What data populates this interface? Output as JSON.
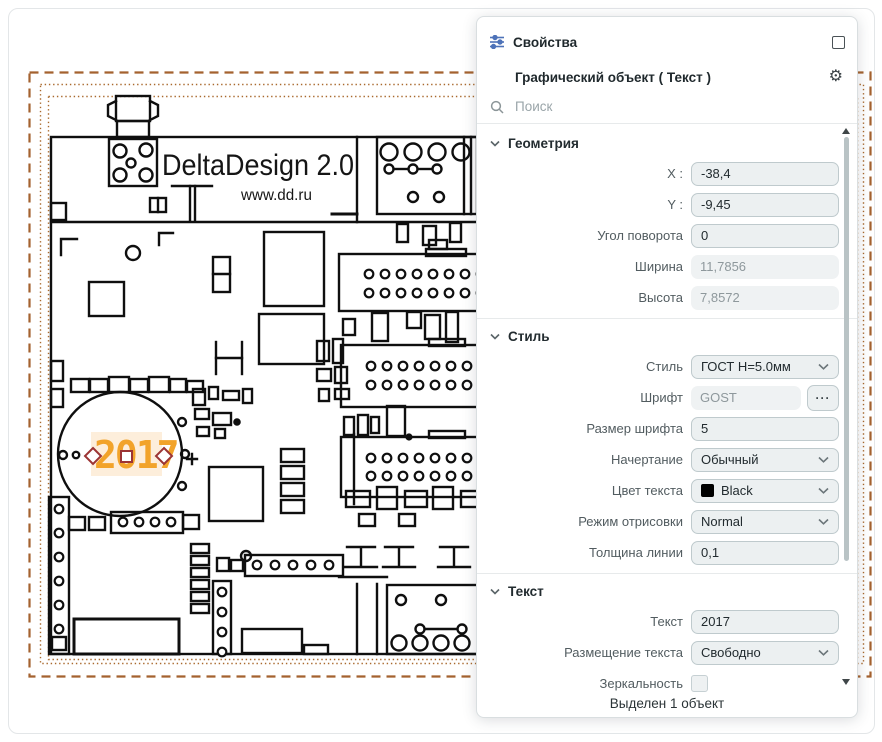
{
  "panel": {
    "header": {
      "title": "Свойства"
    },
    "object_header": {
      "title": "Графический объект ( Текст )"
    },
    "search": {
      "placeholder": "Поиск"
    },
    "sections": {
      "geometry": {
        "title": "Геометрия",
        "rows": [
          {
            "label": "X :",
            "value": "-38,4",
            "type": "input"
          },
          {
            "label": "Y :",
            "value": "-9,45",
            "type": "input"
          },
          {
            "label": "Угол поворота",
            "value": "0",
            "type": "input"
          },
          {
            "label": "Ширина",
            "value": "11,7856",
            "type": "readonly"
          },
          {
            "label": "Высота",
            "value": "7,8572",
            "type": "readonly"
          }
        ]
      },
      "style": {
        "title": "Стиль",
        "rows": [
          {
            "label": "Стиль",
            "value": "ГОСТ H=5.0мм",
            "type": "select"
          },
          {
            "label": "Шрифт",
            "value": "GOST",
            "type": "readonly",
            "button_label": "···"
          },
          {
            "label": "Размер шрифта",
            "value": "5",
            "type": "input"
          },
          {
            "label": "Начертание",
            "value": "Обычный",
            "type": "select"
          },
          {
            "label": "Цвет текста",
            "value": "Black",
            "type": "select",
            "swatch": "#000000"
          },
          {
            "label": "Режим отрисовки",
            "value": "Normal",
            "type": "select"
          },
          {
            "label": "Толщина линии",
            "value": "0,1",
            "type": "input"
          }
        ]
      },
      "text": {
        "title": "Текст",
        "rows": [
          {
            "label": "Текст",
            "value": "2017",
            "type": "input"
          },
          {
            "label": "Размещение текста",
            "value": "Свободно",
            "type": "select"
          },
          {
            "label": "Зеркальность",
            "type": "checkbox",
            "checked": false
          }
        ]
      }
    },
    "status": "Выделен 1 объект"
  },
  "canvas": {
    "brand": "DeltaDesign 2.0",
    "url": "www.dd.ru",
    "selected_text": "2017"
  },
  "icons": {
    "panel_icon": "sliders-icon",
    "float_icon": "float-window-icon",
    "settings_icon": "gear-icon",
    "gear_glyph": "⚙",
    "search_icon": "search-icon",
    "dropdown_icon": "chevron-down-icon",
    "more_icon": "ellipsis-icon"
  },
  "colors": {
    "accent_orange": "#F2A32A",
    "selection_highlight": "#FDEEDB",
    "selection_handle_red": "#9C3434",
    "frame_brown": "#A4622F",
    "text_color_swatch": "#000000",
    "panel_icon_blue": "#4D72B8"
  }
}
